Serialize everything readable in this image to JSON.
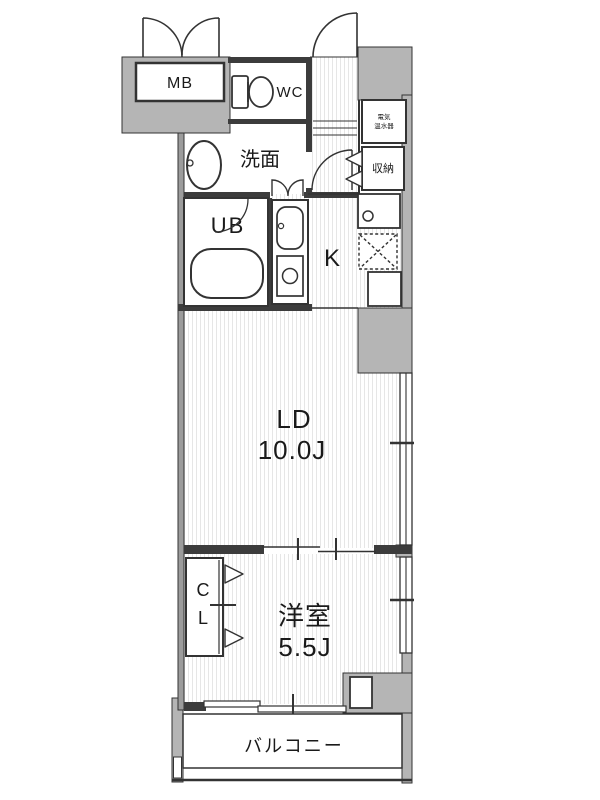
{
  "plan": {
    "title": "apartment-floor-plan",
    "rooms": {
      "mb": "MB",
      "wc": "WC",
      "washroom": "洗面",
      "bath": "UB",
      "kitchen": "K",
      "water_heater": {
        "line1": "電気",
        "line2": "温水器"
      },
      "storage": "収納",
      "living": {
        "name": "LD",
        "size": "10.0J"
      },
      "closet": {
        "line1": "C",
        "line2": "L"
      },
      "bedroom": {
        "name": "洋室",
        "size": "5.5J"
      },
      "balcony": "バルコニー"
    },
    "colors": {
      "wall_fill": "#b5b5b5",
      "line": "#333333",
      "floor_stripe": "#e6e6e6",
      "background": "#ffffff"
    }
  }
}
